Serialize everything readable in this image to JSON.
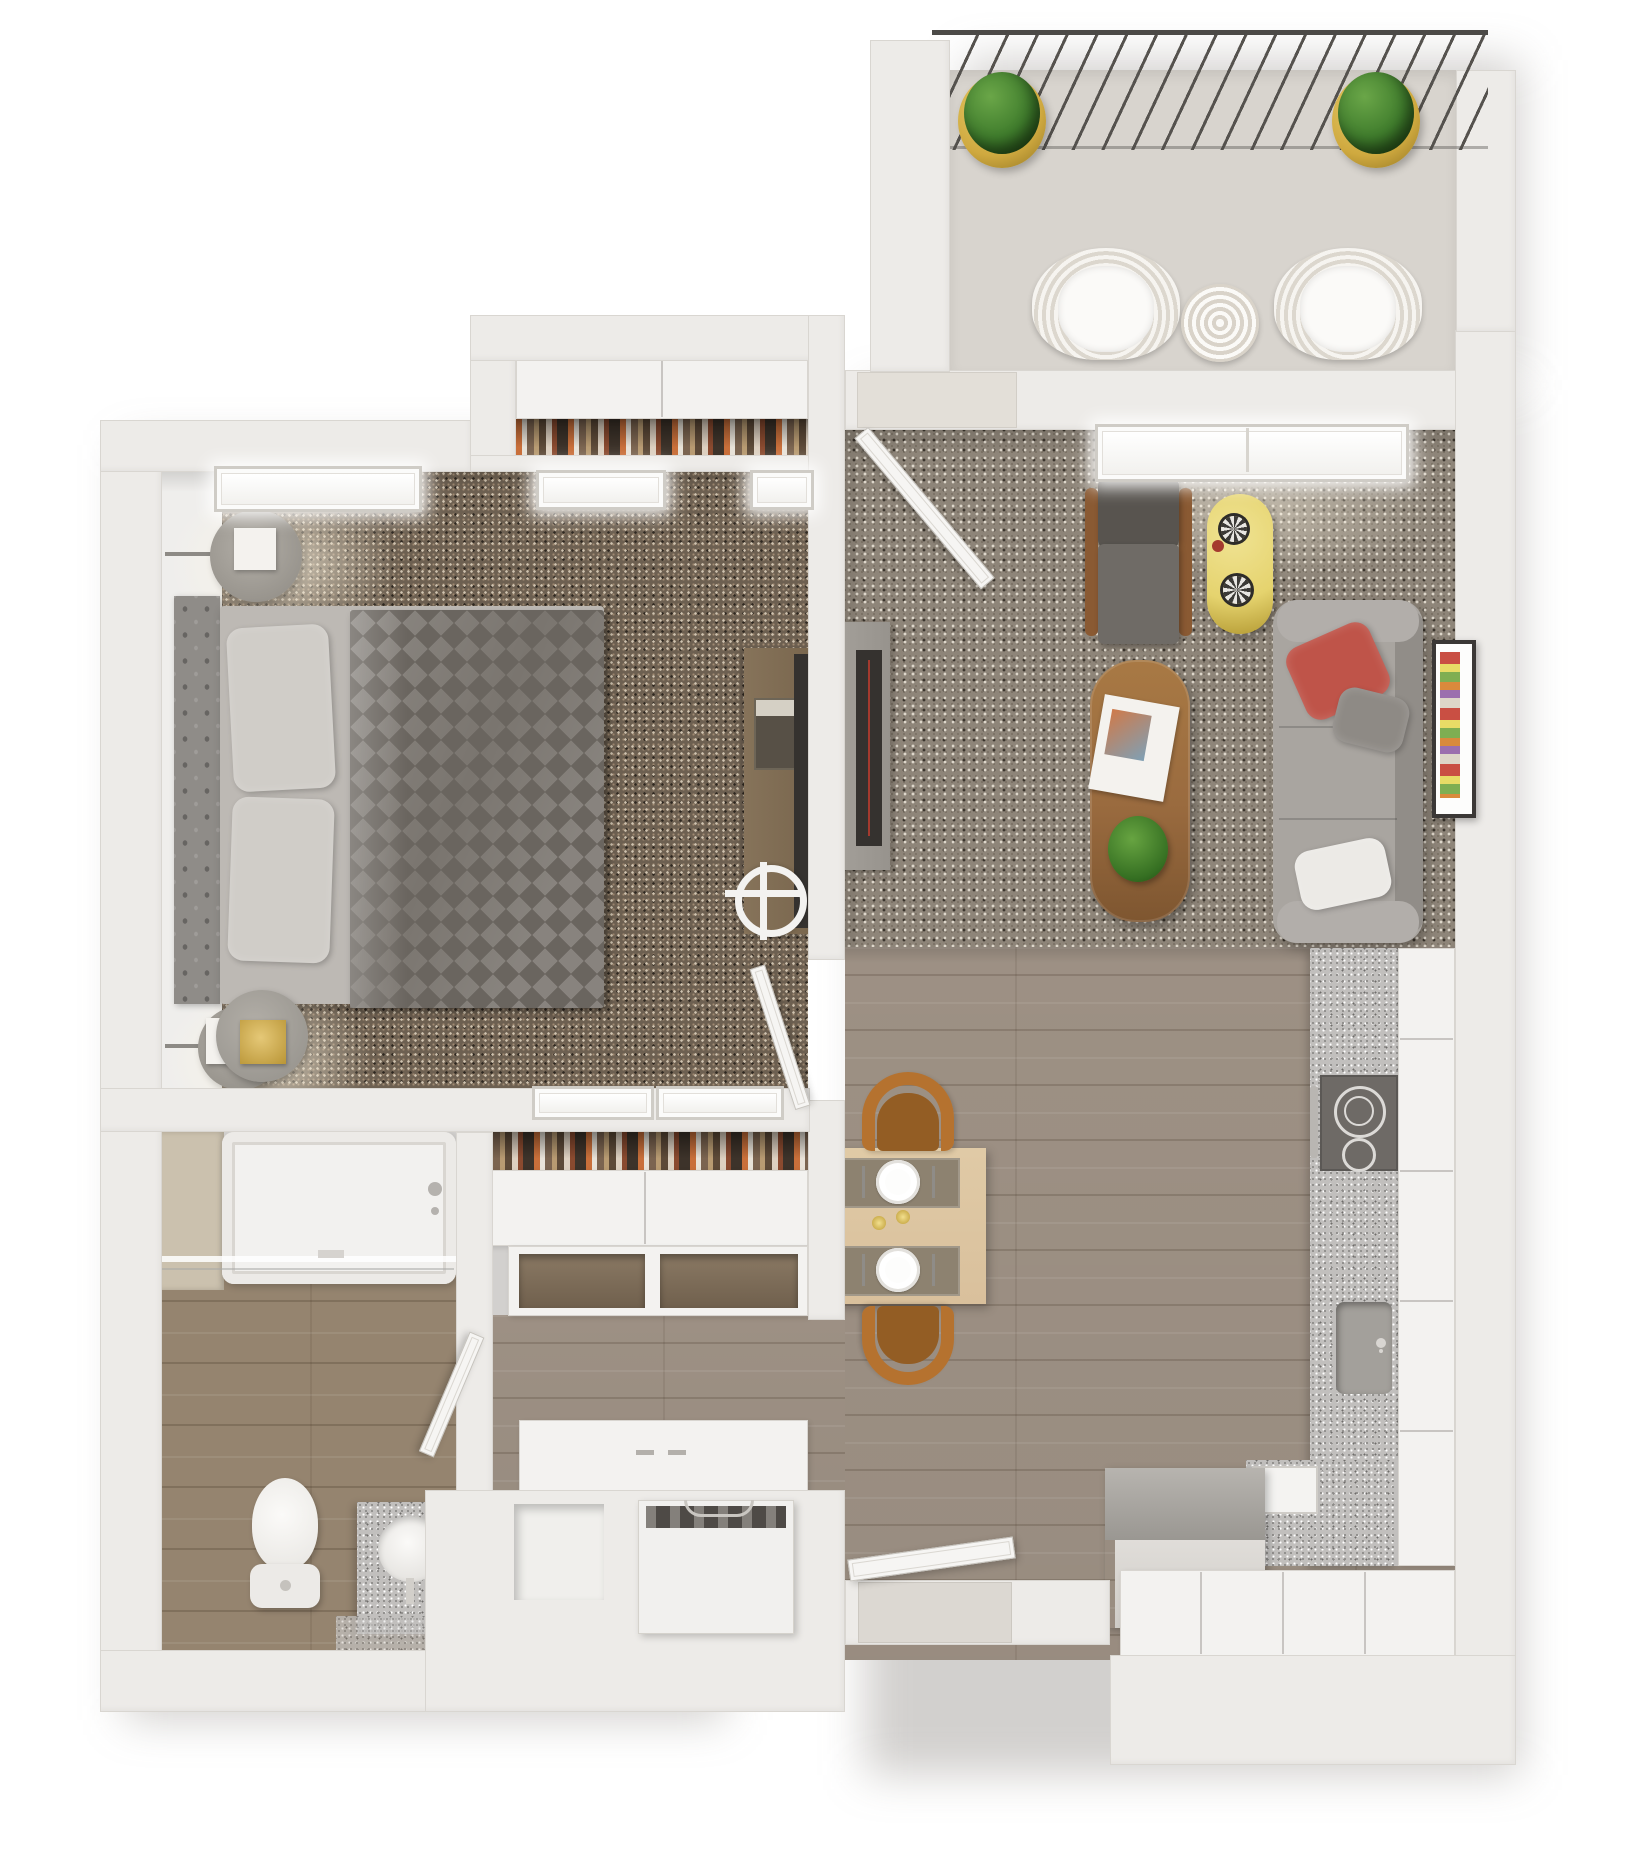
{
  "palette": {
    "wall": "#edebe8",
    "wall_edge": "#d9d6d1",
    "balcony_floor": "#d8d4ce",
    "bedroom_rug": "#6d6051",
    "bedroom_rug_light": "#cfc3b0",
    "bedroom_rug_dark": "#2e2720",
    "living_rug": "#8e8579",
    "living_rug_light": "#ded7cb",
    "living_rug_dark": "#3a342c",
    "wood": "#a29588",
    "wood_bath": "#95846f",
    "granite": "#c1bfbd",
    "door": "#f6f5f3",
    "window": "#fbfbfa",
    "duvet": "#7a756f",
    "duvet_tri": "#6a655f",
    "headboard": "#8f8c88",
    "bed_sheet": "#bdb9b4",
    "sofa": "#a9a5a0",
    "sofa_dark": "#918d88",
    "pillow_red": "#bf5449",
    "pillow_gray": "#8e8a85",
    "pillow_white": "#eceae6",
    "coffee_table_wood": "#9a6b3f",
    "dining_table": "#d9c09c",
    "chair_orange": "#b5722f",
    "chair_orange_dark": "#935d24",
    "side_table_yellow": "#e5d36e",
    "plant_green": "#3f7c2c",
    "pot_gold": "#cfa93f",
    "appliance_dark": "#6e6a66",
    "tv_black": "#35322f",
    "accent_red": "#a53a2e"
  },
  "legend": {
    "balcony": {
      "railing": "balcony railing",
      "plant_left": "potted plant",
      "plant_right": "potted plant",
      "chair_left": "wicker lounge chair",
      "chair_right": "wicker lounge chair",
      "side_table": "round wicker table"
    },
    "bedroom": {
      "bed": "queen bed",
      "headboard": "tufted headboard",
      "pillow_top": "pillow",
      "pillow_bottom": "pillow",
      "duvet": "patterned duvet",
      "lamp_top": "wall lamp",
      "lamp_bottom": "wall lamp",
      "nightstand": "round nightstand",
      "desk": "desk",
      "desk_chair": "desk chair",
      "tv": "wall tv",
      "window_1": "window",
      "window_2": "window",
      "window_3": "window",
      "door": "bedroom door",
      "closet_top": "wardrobe with hanging clothes"
    },
    "living": {
      "sofa": "three-seat sofa",
      "pillow_red": "red throw pillow",
      "pillow_gray": "gray throw pillow",
      "pillow_white": "white throw pillow",
      "armchair": "accent armchair",
      "side_table": "yellow oval side table",
      "coffee_table": "wood coffee table",
      "magazine": "magazine",
      "plant": "table plant",
      "tv_console": "tv console",
      "tv": "television",
      "art": "framed artwork",
      "window": "window",
      "balcony_door": "balcony door"
    },
    "dining": {
      "table": "dining table",
      "chair_top": "dining chair",
      "chair_bottom": "dining chair",
      "placemat_top": "place setting",
      "placemat_bottom": "place setting",
      "candles": "candles"
    },
    "kitchen": {
      "counter_right": "granite counter",
      "stove": "cooktop",
      "sink": "kitchen sink",
      "corner_counter": "granite corner counter",
      "corner_sink": "prep sink",
      "fridge": "refrigerator",
      "lower_cabinets": "lower cabinets",
      "cabinet_run": "cabinet run"
    },
    "bathroom": {
      "tub": "bathtub",
      "shower_glass": "shower glass panel",
      "toilet": "toilet",
      "vanity": "vanity with sink",
      "door": "bathroom door",
      "tile_ledge": "tiled ledge"
    },
    "hall": {
      "closet_drawers": "closet drawer unit",
      "closet_clothes": "hanging clothes",
      "shelf_unit": "open shelves",
      "low_cabinet": "hall cabinet",
      "washer": "washing machine",
      "laundry_niche": "storage niche",
      "entry_door": "entry door"
    }
  }
}
